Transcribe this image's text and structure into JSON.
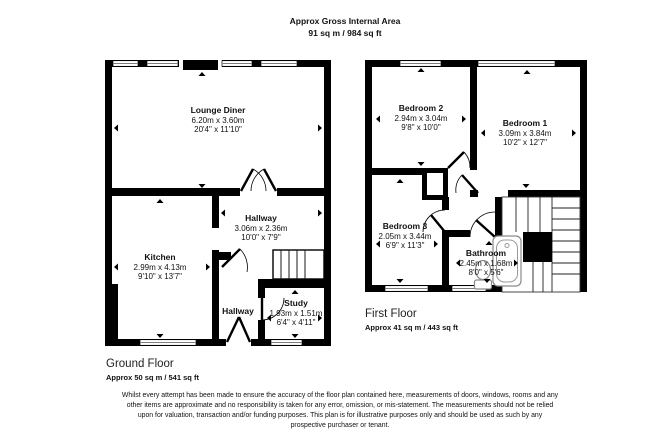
{
  "header": {
    "line1": "Approx Gross Internal Area",
    "line2": "91 sq m / 984 sq ft"
  },
  "ground_floor": {
    "title": "Ground Floor",
    "area": "Approx 50 sq m / 541 sq ft",
    "rooms": [
      {
        "name": "Lounge Diner",
        "metric": "6.20m x 3.60m",
        "imperial": "20'4\" x 11'10\""
      },
      {
        "name": "Hallway",
        "metric": "3.06m x 2.36m",
        "imperial": "10'0\" x 7'9\""
      },
      {
        "name": "Kitchen",
        "metric": "2.99m x 4.13m",
        "imperial": "9'10\" x 13'7\""
      },
      {
        "name": "Hallway",
        "metric": "",
        "imperial": ""
      },
      {
        "name": "Study",
        "metric": "1.93m x 1.51m",
        "imperial": "6'4\" x 4'11\""
      }
    ]
  },
  "first_floor": {
    "title": "First Floor",
    "area": "Approx 41 sq m / 443 sq ft",
    "rooms": [
      {
        "name": "Bedroom 2",
        "metric": "2.94m x 3.04m",
        "imperial": "9'8\" x 10'0\""
      },
      {
        "name": "Bedroom 1",
        "metric": "3.09m x 3.84m",
        "imperial": "10'2\" x 12'7\""
      },
      {
        "name": "Bedroom 3",
        "metric": "2.05m x 3.44m",
        "imperial": "6'9\" x 11'3\""
      },
      {
        "name": "Bathroom",
        "metric": "2.45m x 1.68m",
        "imperial": "8'0\" x 5'6\""
      }
    ]
  },
  "disclaimer": "Whilst every attempt has been made to ensure the accuracy of the floor plan contained here, measurements of doors, windows, rooms and any other items are approximate and no responsibility is taken for any error, omission, or mis-statement. The measurements should not be relied upon for valuation, transaction and/or funding purposes. This plan is for illustrative purposes only and should be used as such by any prospective purchaser or tenant.",
  "colors": {
    "wall": "#000000",
    "window_line": "#7d7d7d",
    "fixture_outline": "#8a8a8a"
  }
}
